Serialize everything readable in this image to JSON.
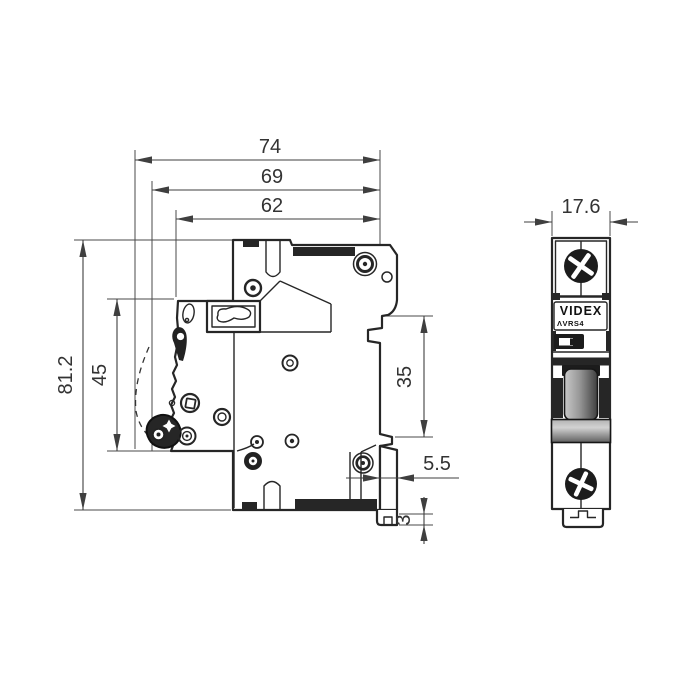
{
  "drawing": {
    "dims": {
      "total_depth": "74",
      "body_depth": "69",
      "front_depth": "62",
      "total_height": "81.2",
      "front_height": "45",
      "din_span": "35",
      "rear_offset": "5.5",
      "foot_lip": "3",
      "width": "17.6"
    },
    "branding": {
      "logo": "VIDEX",
      "model": "ΛVRS4"
    },
    "values_mm": {
      "total_depth": 74,
      "body_depth": 69,
      "front_depth": 62,
      "total_height": 81.2,
      "front_height": 45,
      "din_clip_span": 35,
      "rear_offset": 5.5,
      "foot_lip": 3,
      "width": 17.6
    }
  }
}
